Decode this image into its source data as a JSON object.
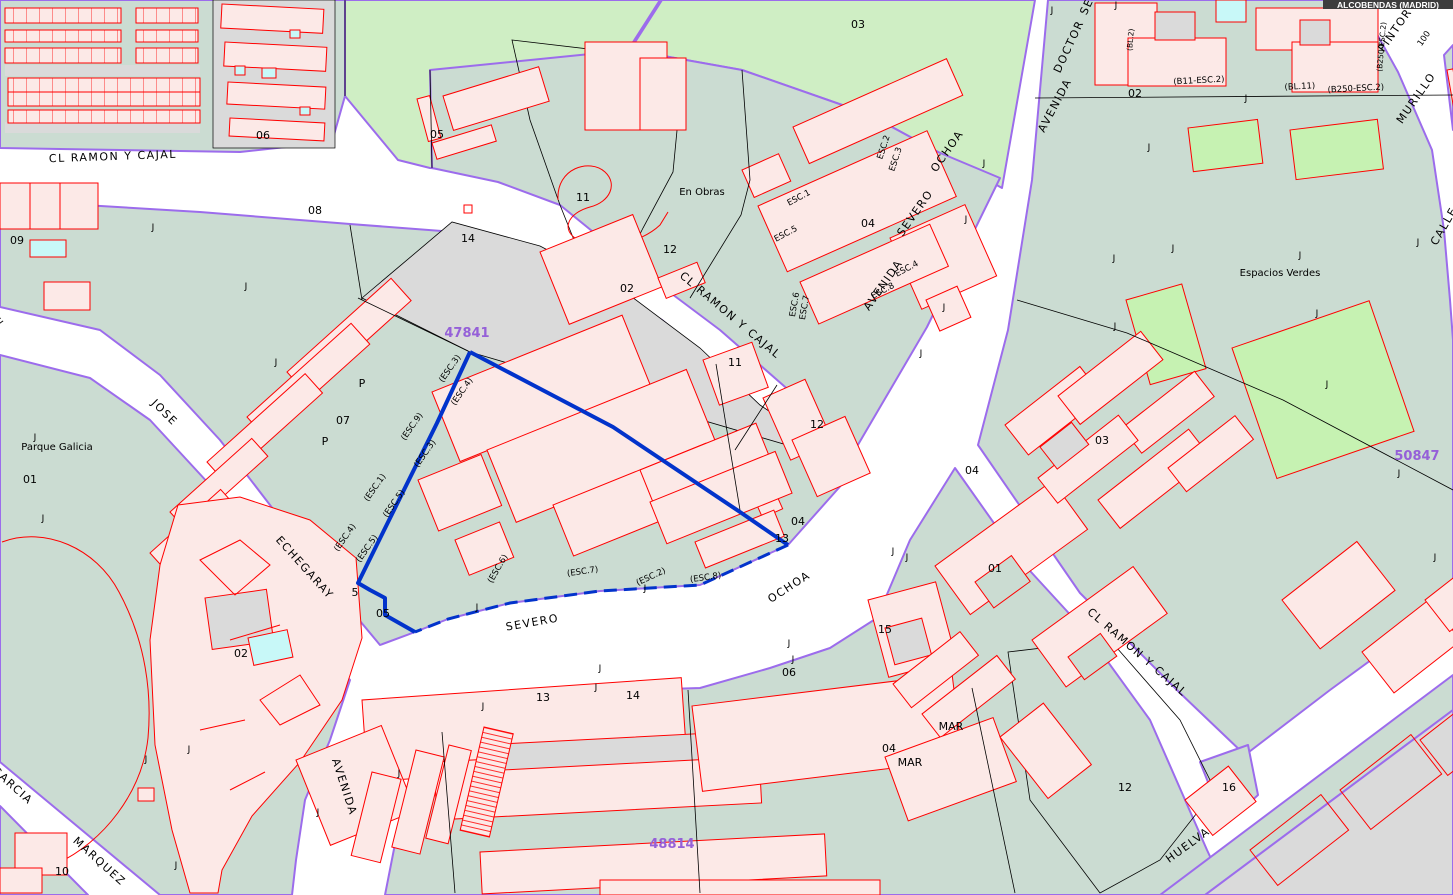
{
  "badge": {
    "text": "ALCOBENDAS (MADRID)"
  },
  "map": {
    "selected_parcel": "47841",
    "palette": {
      "block_green": "#CBDCD2",
      "park_green": "#CFEEC4",
      "sport_field_green": "#C6F2B2",
      "parcel_gray": "#DADADA",
      "building_pink": "#FCE9E7",
      "building_outline_red": "#FF0000",
      "pool_cyan": "#C8F8F8",
      "street_edge_purple": "#9C6CEC",
      "selection_blue": "#0233CB",
      "reference_purple": "#9560D8"
    },
    "labels": [
      {
        "text": "CL RAMON Y CAJAL",
        "x": 113,
        "y": 160,
        "r": -2,
        "cls": "street",
        "name": "street-label"
      },
      {
        "text": "CL RAMON Y CAJAL",
        "x": 728,
        "y": 318,
        "r": 40,
        "cls": "street",
        "name": "street-label"
      },
      {
        "text": "CL RAMON Y CAJAL",
        "x": 1135,
        "y": 655,
        "r": 41,
        "cls": "street",
        "name": "street-label"
      },
      {
        "text": "JOSE",
        "x": 162,
        "y": 415,
        "r": 45,
        "cls": "street",
        "name": "street-label"
      },
      {
        "text": "ECHEGARAY",
        "x": 302,
        "y": 570,
        "r": 48,
        "cls": "street",
        "name": "street-label"
      },
      {
        "text": "AVENIDA",
        "x": 341,
        "y": 788,
        "r": 72,
        "cls": "street",
        "name": "street-label"
      },
      {
        "text": "SEVERO",
        "x": 533,
        "y": 626,
        "r": -10,
        "cls": "street",
        "name": "street-label"
      },
      {
        "text": "OCHOA",
        "x": 791,
        "y": 590,
        "r": -33,
        "cls": "street",
        "name": "street-label"
      },
      {
        "text": "AVENIDA",
        "x": 886,
        "y": 287,
        "r": -55,
        "cls": "street",
        "name": "street-label"
      },
      {
        "text": "SEVERO",
        "x": 918,
        "y": 215,
        "r": -55,
        "cls": "street",
        "name": "street-label"
      },
      {
        "text": "OCHOA",
        "x": 950,
        "y": 153,
        "r": -55,
        "cls": "street",
        "name": "street-label"
      },
      {
        "text": "AVENIDA",
        "x": 1058,
        "y": 107,
        "r": -62,
        "cls": "street",
        "name": "street-label"
      },
      {
        "text": "DOCTOR",
        "x": 1072,
        "y": 48,
        "r": -65,
        "cls": "street",
        "name": "street-label"
      },
      {
        "text": "SE",
        "x": 1090,
        "y": 8,
        "r": -65,
        "cls": "street",
        "name": "street-label"
      },
      {
        "text": "PINTOR",
        "x": 1398,
        "y": 32,
        "r": -55,
        "cls": "street",
        "name": "street-label"
      },
      {
        "text": "MURILLO",
        "x": 1419,
        "y": 100,
        "r": -55,
        "cls": "street",
        "name": "street-label"
      },
      {
        "text": "CALLE",
        "x": 1447,
        "y": 228,
        "r": -60,
        "cls": "street",
        "name": "street-label"
      },
      {
        "text": "CALLE",
        "x": -12,
        "y": 332,
        "r": -35,
        "cls": "street",
        "name": "street-label"
      },
      {
        "text": "GARCIA",
        "x": 10,
        "y": 788,
        "r": 42,
        "cls": "street",
        "name": "street-label"
      },
      {
        "text": "MARQUEZ",
        "x": 97,
        "y": 864,
        "r": 42,
        "cls": "street",
        "name": "street-label"
      },
      {
        "text": "HUELVA",
        "x": 1190,
        "y": 848,
        "r": -36,
        "cls": "street",
        "name": "street-label"
      },
      {
        "text": "100",
        "x": 1426,
        "y": 40,
        "r": -55,
        "cls": "esc",
        "name": "street-number"
      },
      {
        "text": "MAR",
        "x": 951,
        "y": 730,
        "r": 0,
        "cls": "num",
        "name": "info-label"
      },
      {
        "text": "MAR",
        "x": 910,
        "y": 766,
        "r": 0,
        "cls": "num",
        "name": "info-label"
      },
      {
        "text": "47841",
        "x": 467,
        "y": 337,
        "r": 0,
        "cls": "ref",
        "name": "map-sheet-ref"
      },
      {
        "text": "50847",
        "x": 1417,
        "y": 460,
        "r": 0,
        "cls": "ref",
        "name": "map-sheet-ref"
      },
      {
        "text": "48814",
        "x": 672,
        "y": 848,
        "r": 0,
        "cls": "ref",
        "name": "map-sheet-ref"
      },
      {
        "text": "03",
        "x": 858,
        "y": 28,
        "r": 0,
        "cls": "num",
        "name": "parcel-number"
      },
      {
        "text": "06",
        "x": 263,
        "y": 139,
        "r": 0,
        "cls": "num",
        "name": "parcel-number"
      },
      {
        "text": "05",
        "x": 437,
        "y": 138,
        "r": 0,
        "cls": "num",
        "name": "parcel-number"
      },
      {
        "text": "08",
        "x": 315,
        "y": 214,
        "r": 0,
        "cls": "num",
        "name": "parcel-number"
      },
      {
        "text": "09",
        "x": 17,
        "y": 244,
        "r": 0,
        "cls": "num",
        "name": "parcel-number"
      },
      {
        "text": "14",
        "x": 468,
        "y": 242,
        "r": 0,
        "cls": "num",
        "name": "parcel-number"
      },
      {
        "text": "11",
        "x": 583,
        "y": 201,
        "r": 0,
        "cls": "num",
        "name": "parcel-number"
      },
      {
        "text": "12",
        "x": 670,
        "y": 253,
        "r": 0,
        "cls": "num",
        "name": "parcel-number"
      },
      {
        "text": "02",
        "x": 627,
        "y": 292,
        "r": 0,
        "cls": "num",
        "name": "parcel-number"
      },
      {
        "text": "07",
        "x": 343,
        "y": 424,
        "r": 0,
        "cls": "num",
        "name": "parcel-number"
      },
      {
        "text": "P",
        "x": 362,
        "y": 387,
        "r": 0,
        "cls": "num",
        "name": "portal-label"
      },
      {
        "text": "P",
        "x": 325,
        "y": 445,
        "r": 0,
        "cls": "num",
        "name": "portal-label"
      },
      {
        "text": "01",
        "x": 30,
        "y": 483,
        "r": 0,
        "cls": "num",
        "name": "parcel-number"
      },
      {
        "text": "02",
        "x": 241,
        "y": 657,
        "r": 0,
        "cls": "num",
        "name": "parcel-number"
      },
      {
        "text": "10",
        "x": 62,
        "y": 875,
        "r": 0,
        "cls": "num",
        "name": "parcel-number"
      },
      {
        "text": "05",
        "x": 383,
        "y": 617,
        "r": 0,
        "cls": "num",
        "name": "parcel-number"
      },
      {
        "text": "5",
        "x": 355,
        "y": 596,
        "r": 0,
        "cls": "num",
        "name": "parcel-number"
      },
      {
        "text": "13",
        "x": 543,
        "y": 701,
        "r": 0,
        "cls": "num",
        "name": "parcel-number"
      },
      {
        "text": "14",
        "x": 633,
        "y": 699,
        "r": 0,
        "cls": "num",
        "name": "parcel-number"
      },
      {
        "text": "11",
        "x": 735,
        "y": 366,
        "r": 0,
        "cls": "num",
        "name": "parcel-number"
      },
      {
        "text": "12",
        "x": 817,
        "y": 428,
        "r": 0,
        "cls": "num",
        "name": "parcel-number"
      },
      {
        "text": "04",
        "x": 798,
        "y": 525,
        "r": 0,
        "cls": "num",
        "name": "parcel-number"
      },
      {
        "text": "13",
        "x": 782,
        "y": 542,
        "r": 0,
        "cls": "num",
        "name": "parcel-number"
      },
      {
        "text": "06",
        "x": 789,
        "y": 676,
        "r": 0,
        "cls": "num",
        "name": "parcel-number"
      },
      {
        "text": "15",
        "x": 885,
        "y": 633,
        "r": 0,
        "cls": "num",
        "name": "parcel-number"
      },
      {
        "text": "01",
        "x": 995,
        "y": 572,
        "r": 0,
        "cls": "num",
        "name": "parcel-number"
      },
      {
        "text": "04",
        "x": 889,
        "y": 752,
        "r": 0,
        "cls": "num",
        "name": "parcel-number"
      },
      {
        "text": "12",
        "x": 1125,
        "y": 791,
        "r": 0,
        "cls": "num",
        "name": "parcel-number"
      },
      {
        "text": "16",
        "x": 1229,
        "y": 791,
        "r": 0,
        "cls": "num",
        "name": "parcel-number"
      },
      {
        "text": "02",
        "x": 1135,
        "y": 97,
        "r": 0,
        "cls": "num",
        "name": "parcel-number"
      },
      {
        "text": "04",
        "x": 972,
        "y": 474,
        "r": 0,
        "cls": "num",
        "name": "parcel-number"
      },
      {
        "text": "03",
        "x": 1102,
        "y": 444,
        "r": 0,
        "cls": "num",
        "name": "parcel-number"
      },
      {
        "text": "04",
        "x": 868,
        "y": 227,
        "r": 0,
        "cls": "num",
        "name": "parcel-number"
      },
      {
        "text": "ESC.1",
        "x": 800,
        "y": 200,
        "r": -28,
        "cls": "esc",
        "name": "staircase-label"
      },
      {
        "text": "ESC.5",
        "x": 787,
        "y": 236,
        "r": -28,
        "cls": "esc",
        "name": "staircase-label"
      },
      {
        "text": "ESC.2",
        "x": 886,
        "y": 148,
        "r": -72,
        "cls": "esc",
        "name": "staircase-label"
      },
      {
        "text": "ESC.3",
        "x": 898,
        "y": 160,
        "r": -72,
        "cls": "esc",
        "name": "staircase-label"
      },
      {
        "text": "ESC.4",
        "x": 908,
        "y": 271,
        "r": -28,
        "cls": "esc",
        "name": "staircase-label"
      },
      {
        "text": "ESC.8",
        "x": 884,
        "y": 293,
        "r": -28,
        "cls": "esc",
        "name": "staircase-label"
      },
      {
        "text": "ESC.6",
        "x": 797,
        "y": 305,
        "r": -80,
        "cls": "esc",
        "name": "staircase-label"
      },
      {
        "text": "ESC.7",
        "x": 807,
        "y": 308,
        "r": -80,
        "cls": "esc",
        "name": "staircase-label"
      },
      {
        "text": "(ESC.3)",
        "x": 452,
        "y": 370,
        "r": -55,
        "cls": "esc",
        "name": "staircase-label"
      },
      {
        "text": "(ESC.4)",
        "x": 464,
        "y": 393,
        "r": -55,
        "cls": "esc",
        "name": "staircase-label"
      },
      {
        "text": "(ESC.9)",
        "x": 414,
        "y": 428,
        "r": -55,
        "cls": "esc",
        "name": "staircase-label"
      },
      {
        "text": "(ESC.3)",
        "x": 427,
        "y": 455,
        "r": -55,
        "cls": "esc",
        "name": "staircase-label"
      },
      {
        "text": "(ESC.1)",
        "x": 377,
        "y": 489,
        "r": -55,
        "cls": "esc",
        "name": "staircase-label"
      },
      {
        "text": "(ESC.5)",
        "x": 396,
        "y": 505,
        "r": -55,
        "cls": "esc",
        "name": "staircase-label"
      },
      {
        "text": "(ESC.4)",
        "x": 347,
        "y": 539,
        "r": -55,
        "cls": "esc",
        "name": "staircase-label"
      },
      {
        "text": "(ESC.5)",
        "x": 369,
        "y": 550,
        "r": -55,
        "cls": "esc",
        "name": "staircase-label"
      },
      {
        "text": "(ESC.6)",
        "x": 500,
        "y": 570,
        "r": -60,
        "cls": "esc",
        "name": "staircase-label"
      },
      {
        "text": "(ESC.7)",
        "x": 583,
        "y": 574,
        "r": -8,
        "cls": "esc",
        "name": "staircase-label"
      },
      {
        "text": "(ESC.2)",
        "x": 652,
        "y": 579,
        "r": -25,
        "cls": "esc",
        "name": "staircase-label"
      },
      {
        "text": "(ESC.8)",
        "x": 706,
        "y": 580,
        "r": -8,
        "cls": "esc",
        "name": "staircase-label"
      },
      {
        "text": "En Obras",
        "x": 702,
        "y": 195,
        "r": 0,
        "cls": "info",
        "name": "info-label"
      },
      {
        "text": "Espacios Verdes",
        "x": 1280,
        "y": 276,
        "r": 0,
        "cls": "info",
        "name": "info-label"
      },
      {
        "text": "Parque Galicia",
        "x": 57,
        "y": 450,
        "r": 0,
        "cls": "info",
        "name": "info-label"
      },
      {
        "text": "(B11-ESC.2)",
        "x": 1199,
        "y": 83,
        "r": -3,
        "cls": "esc",
        "name": "block-label"
      },
      {
        "text": "(BL.11)",
        "x": 1300,
        "y": 89,
        "r": -3,
        "cls": "esc",
        "name": "block-label"
      },
      {
        "text": "(B250-ESC.2)",
        "x": 1356,
        "y": 91,
        "r": -3,
        "cls": "esc",
        "name": "block-label"
      },
      {
        "text": "(BL.2)",
        "x": 1133,
        "y": 40,
        "r": -85,
        "cls": "tiny",
        "name": "block-label"
      },
      {
        "text": "(B250-ESC.2)",
        "x": 1384,
        "y": 47,
        "r": -85,
        "cls": "tiny",
        "name": "block-label"
      },
      {
        "text": "J",
        "x": 153,
        "y": 230,
        "r": 0,
        "cls": "j",
        "name": "j-marker"
      },
      {
        "text": "J",
        "x": 246,
        "y": 289,
        "r": 0,
        "cls": "j",
        "name": "j-marker"
      },
      {
        "text": "J",
        "x": 276,
        "y": 365,
        "r": 0,
        "cls": "j",
        "name": "j-marker"
      },
      {
        "text": "J",
        "x": 35,
        "y": 440,
        "r": 0,
        "cls": "j",
        "name": "j-marker"
      },
      {
        "text": "J",
        "x": 43,
        "y": 521,
        "r": 0,
        "cls": "j",
        "name": "j-marker"
      },
      {
        "text": "J",
        "x": 146,
        "y": 762,
        "r": 0,
        "cls": "j",
        "name": "j-marker"
      },
      {
        "text": "J",
        "x": 189,
        "y": 752,
        "r": 0,
        "cls": "j",
        "name": "j-marker"
      },
      {
        "text": "J",
        "x": 176,
        "y": 868,
        "r": 0,
        "cls": "j",
        "name": "j-marker"
      },
      {
        "text": "J",
        "x": 399,
        "y": 776,
        "r": 0,
        "cls": "j",
        "name": "j-marker"
      },
      {
        "text": "J",
        "x": 318,
        "y": 815,
        "r": 0,
        "cls": "j",
        "name": "j-marker"
      },
      {
        "text": "J",
        "x": 477,
        "y": 610,
        "r": 0,
        "cls": "j",
        "name": "j-marker"
      },
      {
        "text": "J",
        "x": 645,
        "y": 591,
        "r": 0,
        "cls": "j",
        "name": "j-marker"
      },
      {
        "text": "J",
        "x": 600,
        "y": 671,
        "r": 0,
        "cls": "j",
        "name": "j-marker"
      },
      {
        "text": "J",
        "x": 596,
        "y": 690,
        "r": 0,
        "cls": "j",
        "name": "j-marker"
      },
      {
        "text": "J",
        "x": 483,
        "y": 709,
        "r": 0,
        "cls": "j",
        "name": "j-marker"
      },
      {
        "text": "J",
        "x": 789,
        "y": 646,
        "r": 0,
        "cls": "j",
        "name": "j-marker"
      },
      {
        "text": "J",
        "x": 793,
        "y": 662,
        "r": 0,
        "cls": "j",
        "name": "j-marker"
      },
      {
        "text": "J",
        "x": 921,
        "y": 356,
        "r": 0,
        "cls": "j",
        "name": "j-marker"
      },
      {
        "text": "J",
        "x": 944,
        "y": 310,
        "r": 0,
        "cls": "j",
        "name": "j-marker"
      },
      {
        "text": "J",
        "x": 966,
        "y": 222,
        "r": 0,
        "cls": "j",
        "name": "j-marker"
      },
      {
        "text": "J",
        "x": 984,
        "y": 166,
        "r": 0,
        "cls": "j",
        "name": "j-marker"
      },
      {
        "text": "J",
        "x": 893,
        "y": 554,
        "r": 0,
        "cls": "j",
        "name": "j-marker"
      },
      {
        "text": "J",
        "x": 907,
        "y": 560,
        "r": 0,
        "cls": "j",
        "name": "j-marker"
      },
      {
        "text": "J",
        "x": 1052,
        "y": 13,
        "r": 0,
        "cls": "j",
        "name": "j-marker"
      },
      {
        "text": "J",
        "x": 1116,
        "y": 8,
        "r": 0,
        "cls": "j",
        "name": "j-marker"
      },
      {
        "text": "J",
        "x": 1114,
        "y": 261,
        "r": 0,
        "cls": "j",
        "name": "j-marker"
      },
      {
        "text": "J",
        "x": 1149,
        "y": 150,
        "r": 0,
        "cls": "j",
        "name": "j-marker"
      },
      {
        "text": "J",
        "x": 1246,
        "y": 101,
        "r": 0,
        "cls": "j",
        "name": "j-marker"
      },
      {
        "text": "J",
        "x": 1300,
        "y": 258,
        "r": 0,
        "cls": "j",
        "name": "j-marker"
      },
      {
        "text": "J",
        "x": 1173,
        "y": 251,
        "r": 0,
        "cls": "j",
        "name": "j-marker"
      },
      {
        "text": "J",
        "x": 1418,
        "y": 245,
        "r": 0,
        "cls": "j",
        "name": "j-marker"
      },
      {
        "text": "J",
        "x": 1115,
        "y": 329,
        "r": 0,
        "cls": "j",
        "name": "j-marker"
      },
      {
        "text": "J",
        "x": 1317,
        "y": 316,
        "r": 0,
        "cls": "j",
        "name": "j-marker"
      },
      {
        "text": "J",
        "x": 1327,
        "y": 387,
        "r": 0,
        "cls": "j",
        "name": "j-marker"
      },
      {
        "text": "J",
        "x": 1399,
        "y": 476,
        "r": 0,
        "cls": "j",
        "name": "j-marker"
      },
      {
        "text": "J",
        "x": 1435,
        "y": 560,
        "r": 0,
        "cls": "j",
        "name": "j-marker"
      }
    ]
  }
}
